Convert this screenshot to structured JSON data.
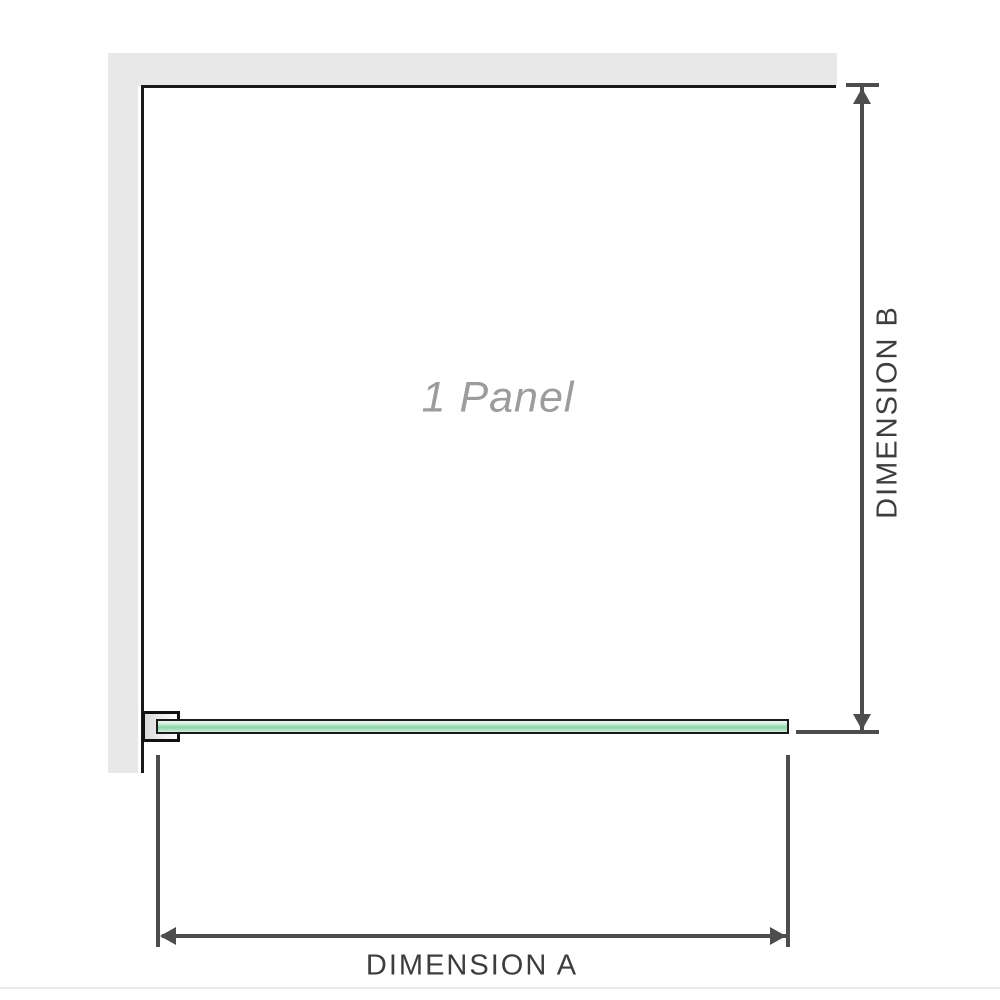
{
  "diagram": {
    "panel_label": "1 Panel",
    "dimension_a_label": "DIMENSION A",
    "dimension_b_label": "DIMENSION B",
    "colors": {
      "wall_fill": "#e8e8e8",
      "structure_line": "#1a1a1a",
      "glass_green_mid": "#8fd5ac",
      "glass_green_light": "#d6efdf",
      "dimension_line": "#4d4d4d",
      "dimension_label_text": "#3d3d3d",
      "panel_label_text": "#9c9c9c",
      "bottom_separator": "#ebebeb"
    }
  }
}
